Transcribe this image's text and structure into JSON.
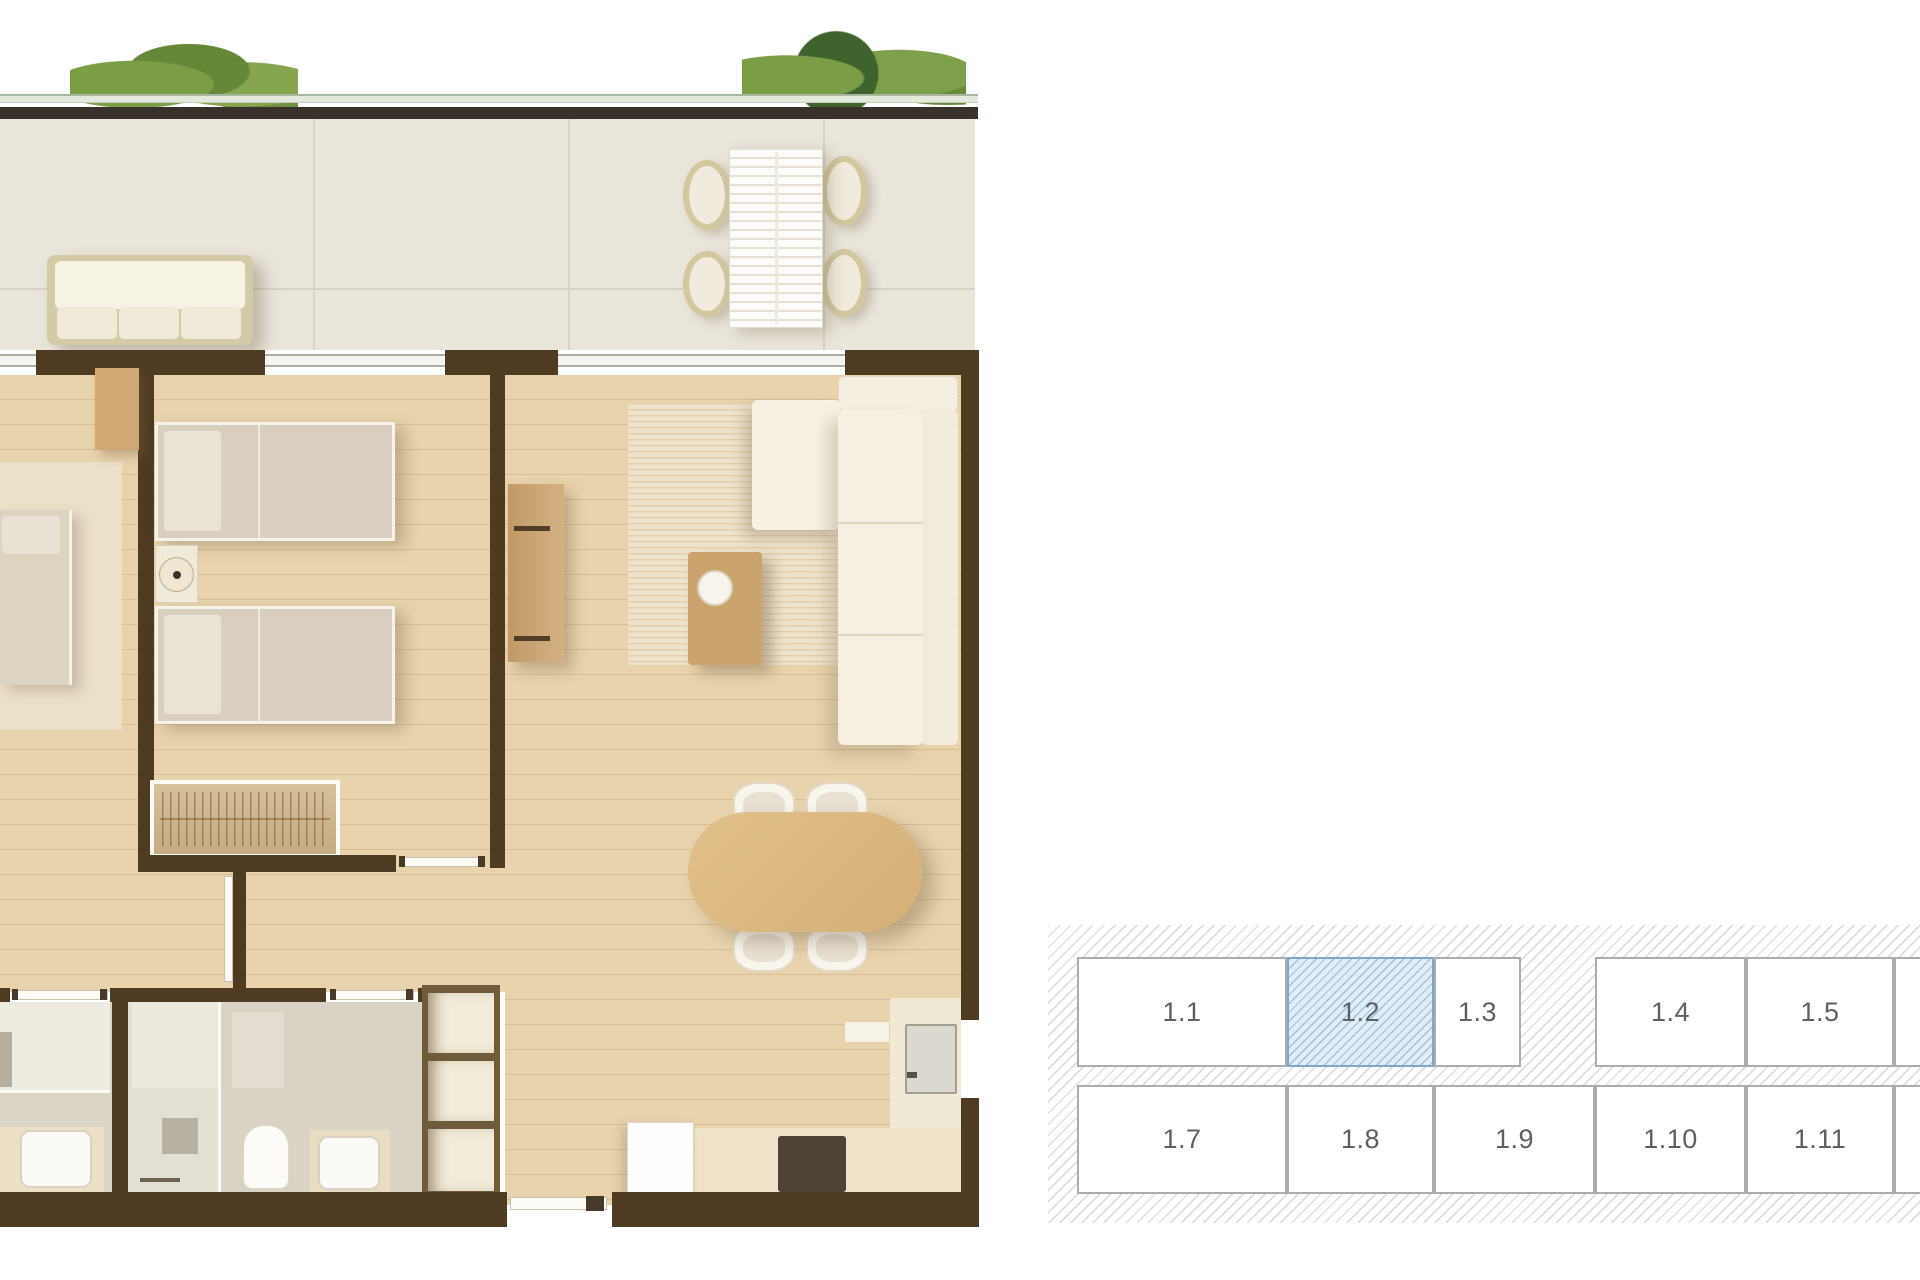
{
  "unit_map": {
    "highlighted_unit": "1.2",
    "hatch_line_color": "#d7d7d7",
    "cell_border_color": "#acacac",
    "label_color": "#5d6165",
    "highlight": {
      "border": "#7ea8ca",
      "background": "#e1eef7",
      "hatch": "#9fc2dc"
    },
    "rows": [
      {
        "cells": [
          {
            "label": "1.1",
            "highlighted": false
          },
          {
            "label": "1.2",
            "highlighted": true
          },
          {
            "label": "1.3",
            "highlighted": false
          },
          {
            "label": "1.4",
            "highlighted": false
          },
          {
            "label": "1.5",
            "highlighted": false
          },
          {
            "label": "",
            "highlighted": false
          }
        ]
      },
      {
        "cells": [
          {
            "label": "1.7",
            "highlighted": false
          },
          {
            "label": "1.8",
            "highlighted": false
          },
          {
            "label": "1.9",
            "highlighted": false
          },
          {
            "label": "1.10",
            "highlighted": false
          },
          {
            "label": "1.11",
            "highlighted": false
          },
          {
            "label": "",
            "highlighted": false
          }
        ]
      }
    ]
  },
  "floor_plan": {
    "wall_color": "#4f3b22",
    "wood_floor_color": "#e8d3ac",
    "terrace_tile_color": "#eae5db",
    "bathroom_floor_color": "#dad4c6",
    "plant_color": "#6f923f",
    "elements": [
      "terrace",
      "planters",
      "glass-balustrade",
      "outdoor-sofa",
      "outdoor-dining-set",
      "living-room",
      "sofa",
      "rug",
      "coffee-table",
      "tv-sideboard",
      "dining-table",
      "dining-chairs",
      "kitchen",
      "fridge",
      "cooktop",
      "entry-door",
      "bedroom-1",
      "twin-beds",
      "nightstand",
      "wardrobe",
      "bedroom-2",
      "bed",
      "desk",
      "hall",
      "bathroom-1",
      "bathroom-2",
      "shower",
      "toilet",
      "sink",
      "storage-shelves"
    ]
  }
}
